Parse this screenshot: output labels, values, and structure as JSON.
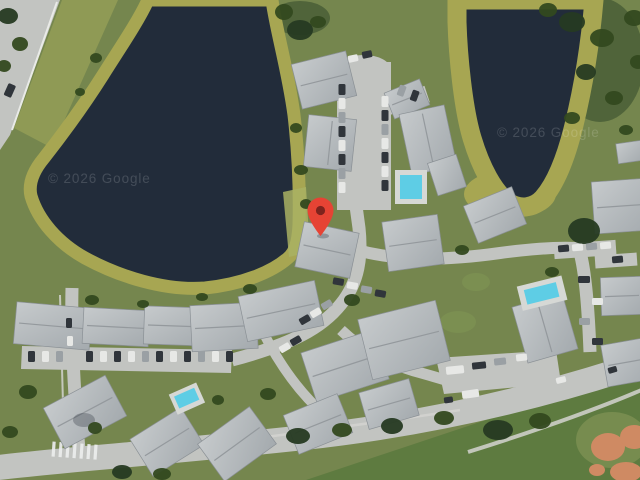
{
  "view": {
    "type": "satellite-map",
    "description": "Aerial satellite view of a lakeside residential condominium complex with a red location marker"
  },
  "watermarks": {
    "left": "© 2026 Google",
    "right": "© 2026 Google"
  },
  "marker": {
    "label": "dropped-pin",
    "color": "#e64334",
    "dot_color": "#7e231d",
    "x": 320,
    "y": 216
  },
  "colors": {
    "lake": "#222c3a",
    "algae_shore": "#a7a652",
    "grass": "#75864e",
    "grass_bright": "#5e7b40",
    "roof": "#b6babd",
    "road": "#c2c4c1",
    "pool": "#5ecde5",
    "clay": "#cf8a63"
  },
  "features": {
    "water": "lake",
    "pools": [
      "north-pool",
      "east-pool",
      "southwest-pool"
    ],
    "roads": [
      "northwest-highway",
      "south-perimeter-road",
      "west-entrance-road"
    ],
    "areas": [
      "condo-buildings",
      "parking-lots",
      "southeast-playfield"
    ]
  }
}
